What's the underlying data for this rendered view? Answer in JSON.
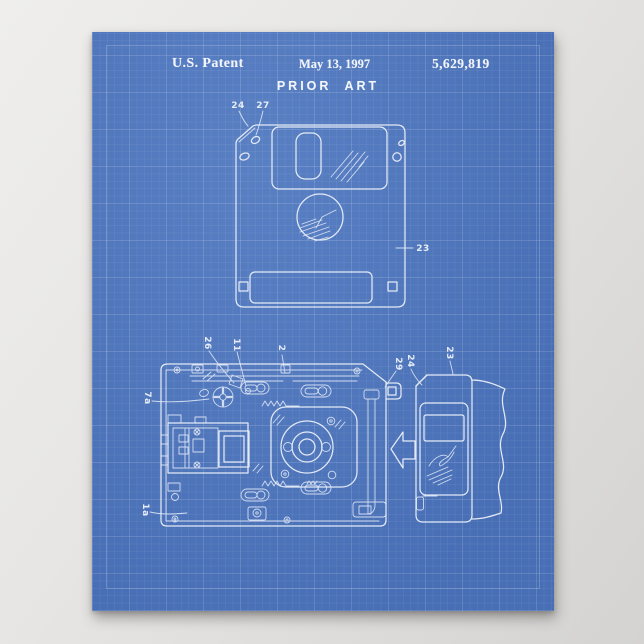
{
  "page": {
    "background_color": "#e4e3e1"
  },
  "poster": {
    "colors": {
      "blueprint_blue": "#4d76bf",
      "grid_line": "rgba(255,255,255,0.10)",
      "ink_white": "#eef3fb"
    },
    "header": {
      "publication": "U.S. Patent",
      "date": "May 13, 1997",
      "patent_number": "5,629,819"
    },
    "title": "PRIOR ART",
    "figure_front": {
      "labels": {
        "corner": "24",
        "hole": "27",
        "body": "23"
      }
    },
    "figure_mechanism": {
      "labels": {
        "latch": "26",
        "lever": "11",
        "cover": "2",
        "gear": "7a",
        "base": "1a",
        "bracket": "29",
        "disk_corner": "24",
        "disk_body": "23"
      }
    }
  }
}
